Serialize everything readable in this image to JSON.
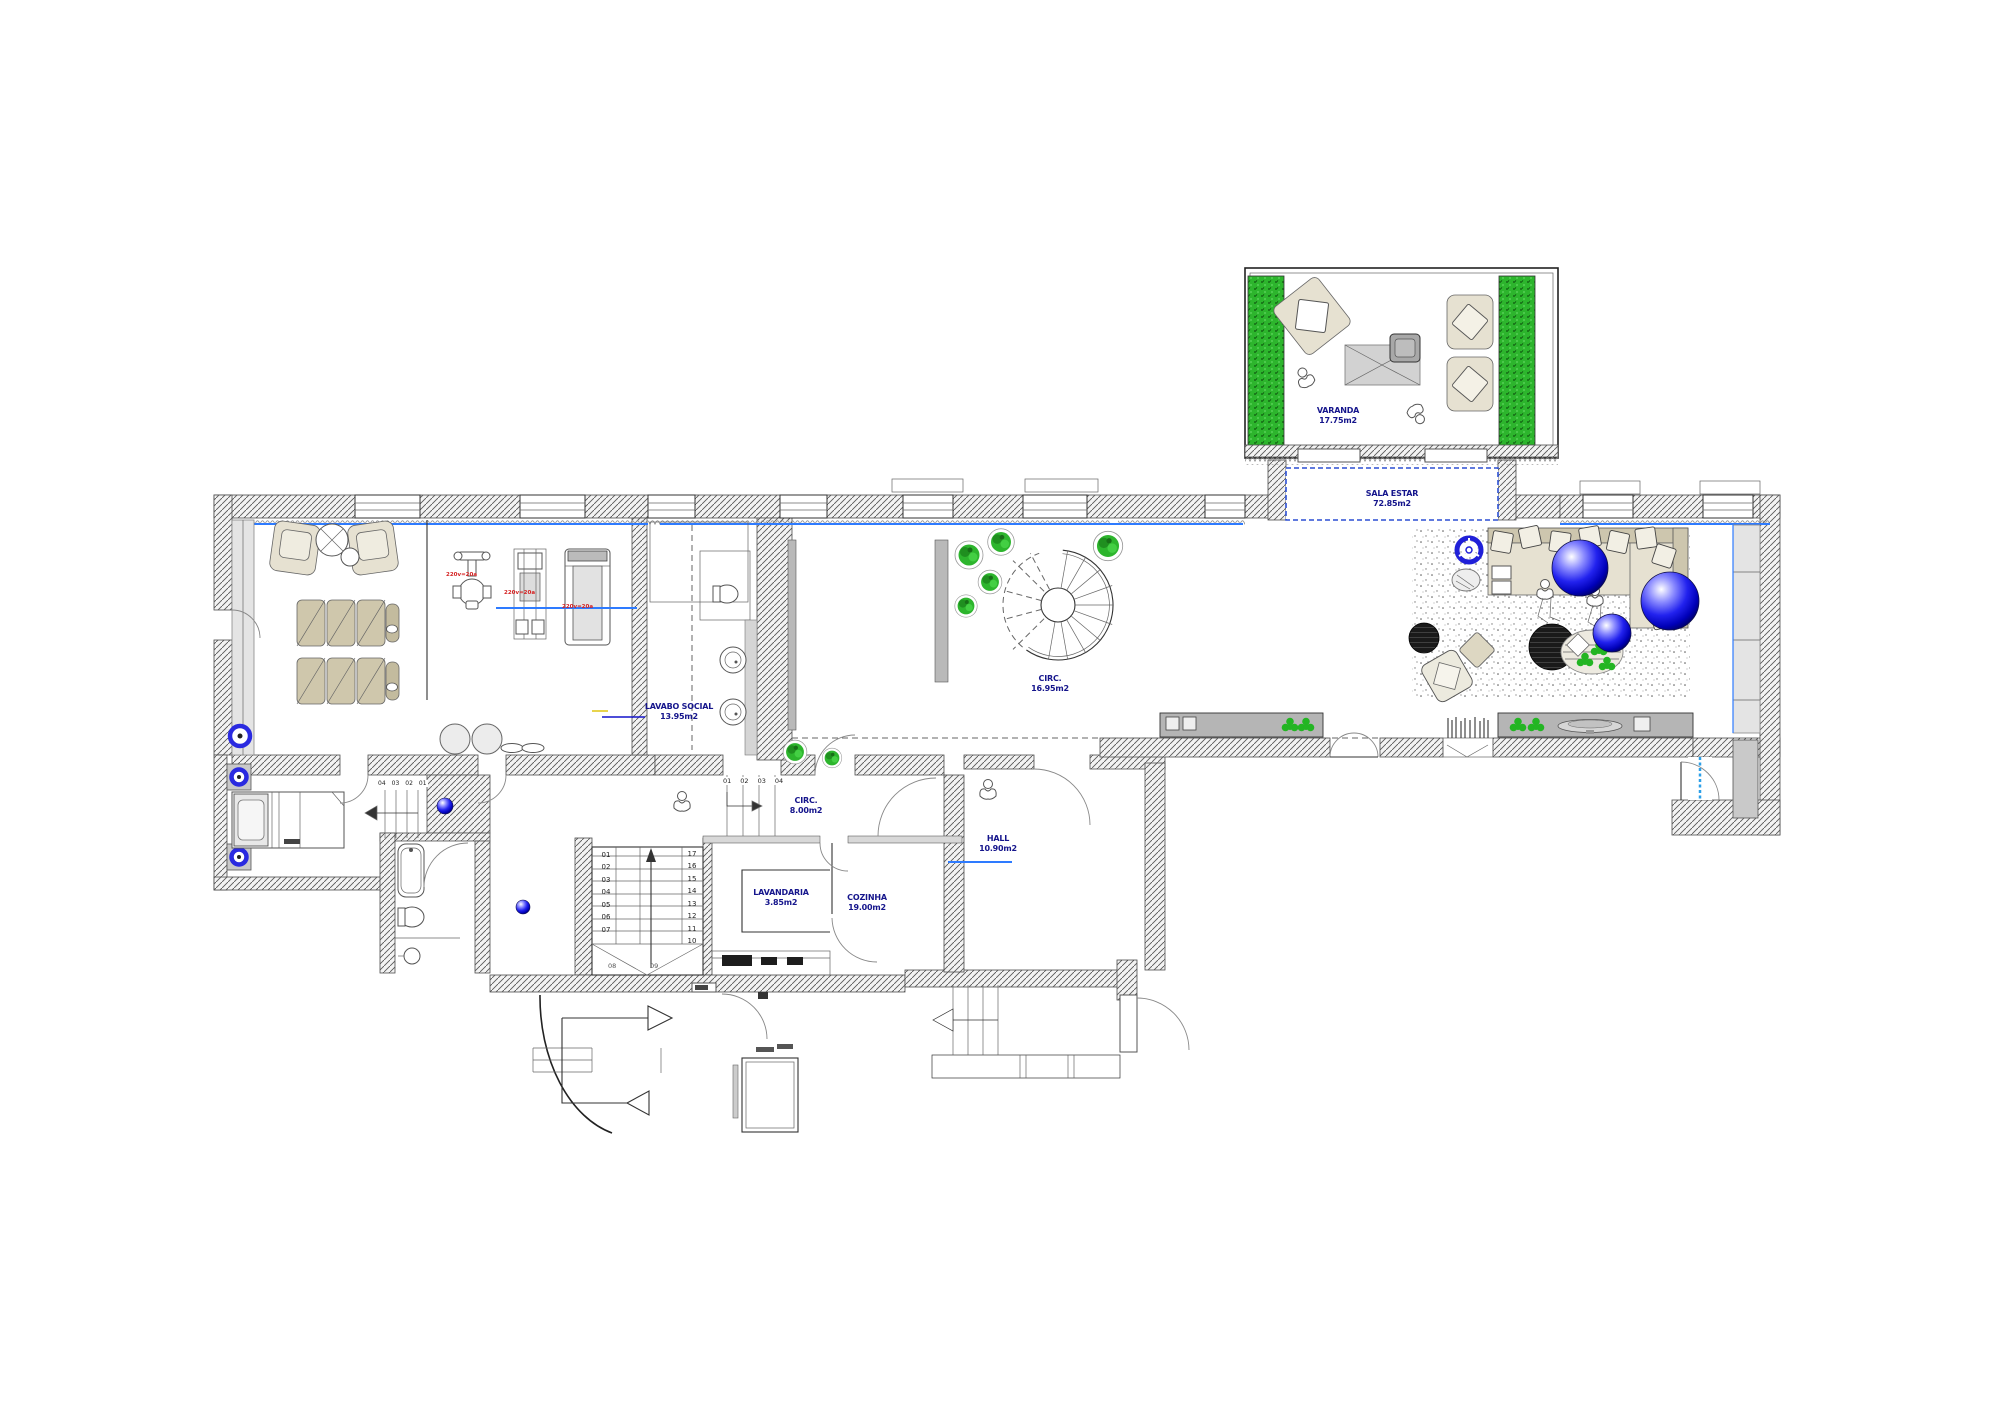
{
  "drawing": {
    "type": "architectural floor plan",
    "floor": "social / ground floor apartment plan"
  },
  "colors": {
    "room_label_navy": "#15158c",
    "equipment_label_red": "#d42222",
    "glazing_blue": "#2e7bff",
    "opening_dashed_blue": "#2b4fd4",
    "plant_green": "#2db52d",
    "sphere_blue": "#2222ee",
    "upholstery_beige": "#cfc7ac",
    "wall_hatch_grey": "#4d4d4d"
  },
  "rooms": {
    "varanda": {
      "name": "VARANDA",
      "area": "17.75m2"
    },
    "sala_estar": {
      "name": "SALA ESTAR",
      "area": "72.85m2"
    },
    "circ": {
      "name": "CIRC.",
      "area": "16.95m2"
    },
    "lavabo_social": {
      "name": "LAVABO SOCIAL",
      "area": "13.95m2"
    },
    "circ2": {
      "name": "CIRC.",
      "area": "8.00m2"
    },
    "hall": {
      "name": "HALL",
      "area": "10.90m2"
    },
    "lavandaria": {
      "name": "LAVANDARIA",
      "area": "3.85m2"
    },
    "cozinha": {
      "name": "COZINHA",
      "area": "19.00m2"
    }
  },
  "stairs": {
    "main": {
      "left": [
        "01",
        "02",
        "03",
        "04",
        "05",
        "06",
        "07"
      ],
      "right": [
        "17",
        "16",
        "15",
        "14",
        "13",
        "12",
        "11",
        "10"
      ],
      "landing": [
        "08",
        "09"
      ]
    },
    "winder_top": [
      "01",
      "02",
      "03",
      "04"
    ],
    "bedroom": [
      "04",
      "03",
      "02",
      "01"
    ]
  },
  "gym": {
    "equipment_labels": [
      "220v=20a",
      "220v=20a",
      "220v=20a"
    ]
  }
}
